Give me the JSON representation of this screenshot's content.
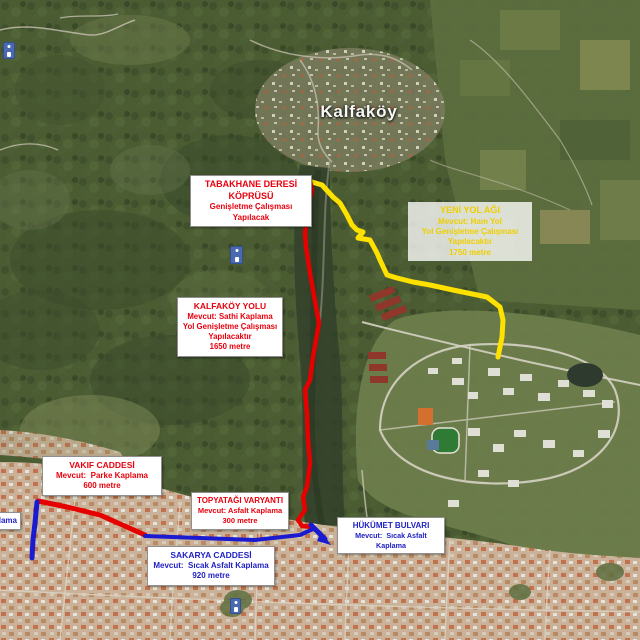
{
  "map": {
    "place_label": "Kalfaköy",
    "edge_label_fragment": "plama"
  },
  "boxes": {
    "tabakhane_deresi_koprusu": {
      "lines": [
        "TABAKHANE DERESİ",
        "KÖPRÜSÜ",
        "Genişletme Çalışması",
        "Yapılacak"
      ],
      "text_color": "#e8000d"
    },
    "yeni_yol_agi": {
      "lines": [
        "YENİ YOL AĞI",
        "Mevcut: Ham Yol",
        "Yol Genişletme Çalışması",
        "Yapılacaktır",
        "1750 metre"
      ],
      "text_color": "#efce00"
    },
    "kalfakoy_yolu": {
      "lines": [
        "KALFAKÖY YOLU",
        "Mevcut: Sathi Kaplama",
        "Yol Genişletme Çalışması",
        "Yapılacaktır",
        "1650 metre"
      ],
      "text_color": "#e8000d"
    },
    "vakif_caddesi": {
      "lines": [
        "VAKIF CADDESİ",
        "Mevcut:  Parke Kaplama",
        "600 metre"
      ],
      "text_color": "#e8000d"
    },
    "topyatagi_varyanti": {
      "lines": [
        "TOPYATAĞI VARYANTI",
        "Mevcut: Asfalt Kaplama",
        "300 metre"
      ],
      "text_color": "#e8000d"
    },
    "hukumet_bulvari": {
      "lines": [
        "HÜKÜMET BULVARI",
        "Mevcut:  Sıcak Asfalt Kaplama"
      ],
      "text_color": "#2121c4"
    },
    "sakarya_caddesi": {
      "lines": [
        "SAKARYA CADDESİ",
        "Mevcut:  Sıcak Asfalt Kaplama",
        "920 metre"
      ],
      "text_color": "#2121c4"
    }
  },
  "routes": [
    {
      "name": "Kalfaköy Yolu",
      "color": "#e60000"
    },
    {
      "name": "Vakıf Caddesi",
      "color": "#e60000"
    },
    {
      "name": "Topyatağı Varyantı",
      "color": "#e60000"
    },
    {
      "name": "Yeni Yol Ağı",
      "color": "#ffe100"
    },
    {
      "name": "Sakarya Caddesi",
      "color": "#1a1ad1"
    },
    {
      "name": "Hükümet Bulvarı",
      "color": "#1a1ad1"
    }
  ],
  "icons": [
    "poi-marker",
    "poi-marker",
    "poi-marker"
  ],
  "colors": {
    "route_red": "#e60000",
    "route_yellow": "#ffe100",
    "route_blue": "#1a1ad1"
  }
}
